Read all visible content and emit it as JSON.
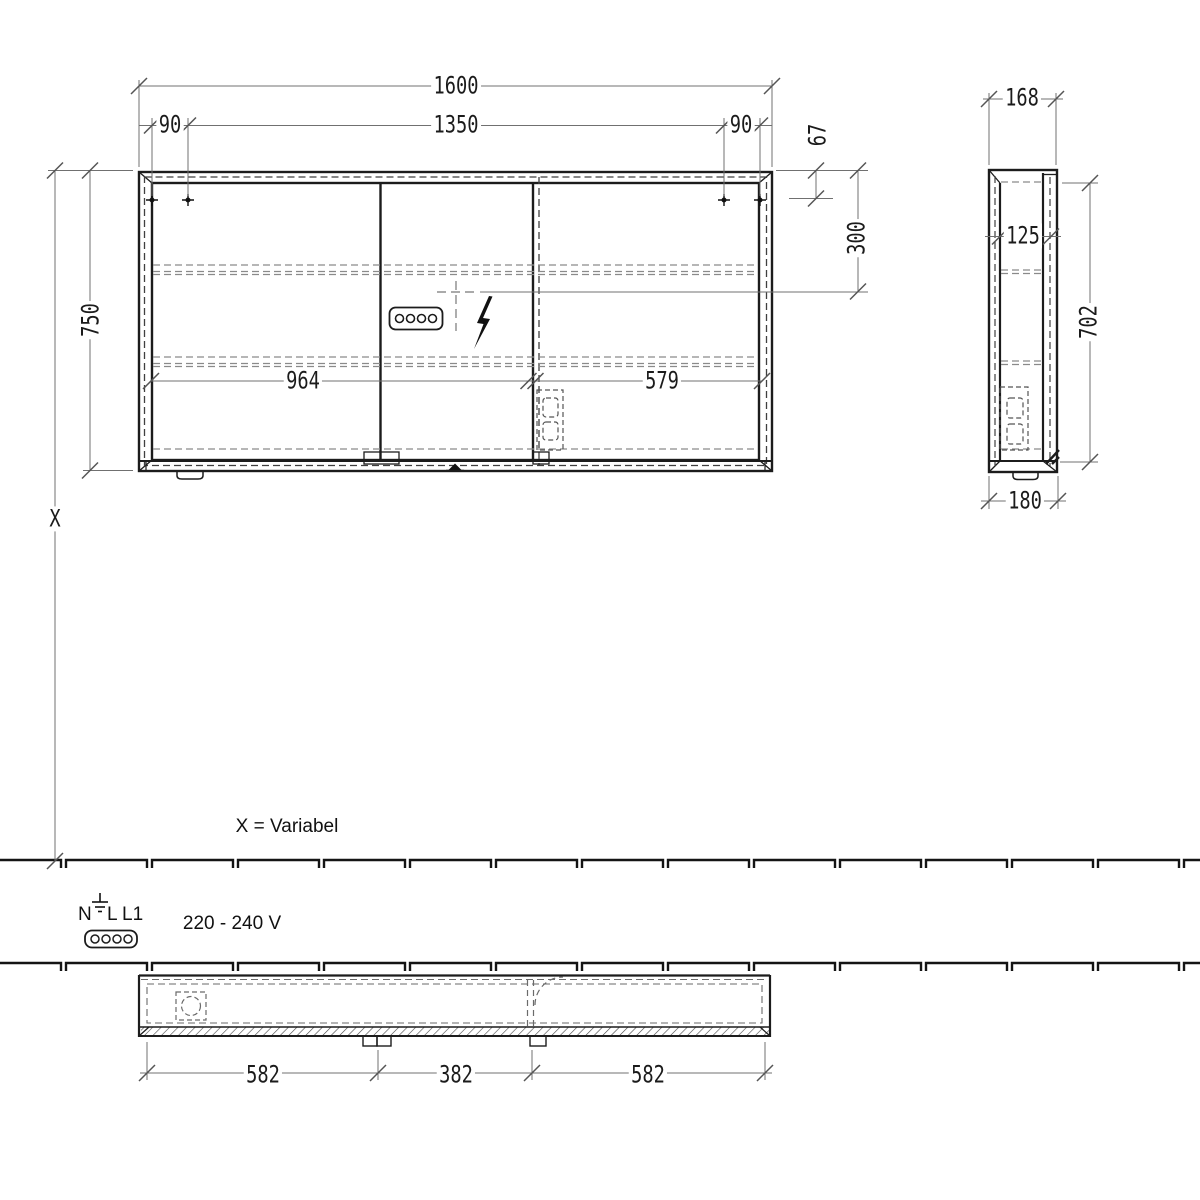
{
  "front": {
    "total_width": "1600",
    "inner_width": "1350",
    "hole_offset_left": "90",
    "hole_offset_right": "90",
    "top_to_holes": "67",
    "top_to_socket": "300",
    "height": "750",
    "height_variable": "X",
    "door_left_width": "964",
    "door_right_width": "579"
  },
  "side": {
    "depth_top": "168",
    "depth_inner": "125",
    "height_inner": "702",
    "depth_bottom": "180"
  },
  "plan": {
    "segment_left": "582",
    "segment_center": "382",
    "segment_right": "582"
  },
  "notes": {
    "variable_note": "X = Variabel",
    "voltage_range": "220 - 240 V",
    "terminal_n": "N",
    "terminal_l": "L",
    "terminal_l1": "L1"
  }
}
